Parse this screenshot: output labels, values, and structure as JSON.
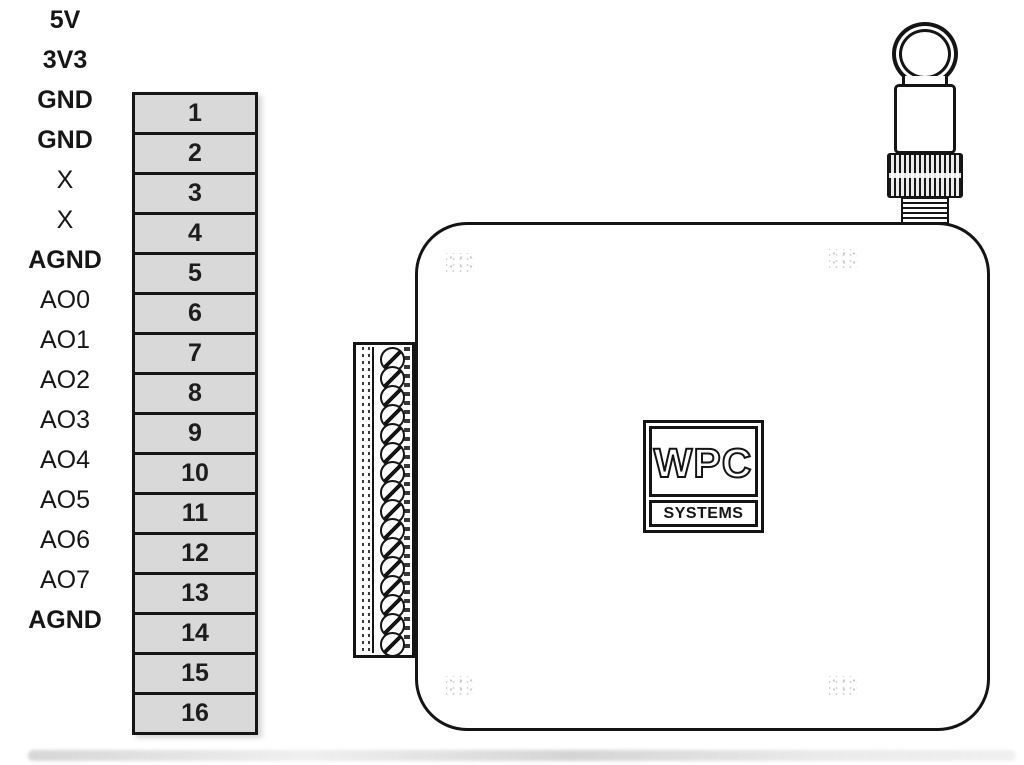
{
  "pin_table": {
    "cell_fill": "#d9d9d9",
    "border_color": "#161616",
    "rows": [
      {
        "label": "5V",
        "pin": "1",
        "bold_label": true
      },
      {
        "label": "3V3",
        "pin": "2",
        "bold_label": true
      },
      {
        "label": "GND",
        "pin": "3",
        "bold_label": true
      },
      {
        "label": "GND",
        "pin": "4",
        "bold_label": true
      },
      {
        "label": "X",
        "pin": "5",
        "bold_label": false
      },
      {
        "label": "X",
        "pin": "6",
        "bold_label": false
      },
      {
        "label": "AGND",
        "pin": "7",
        "bold_label": true
      },
      {
        "label": "AO0",
        "pin": "8",
        "bold_label": false
      },
      {
        "label": "AO1",
        "pin": "9",
        "bold_label": false
      },
      {
        "label": "AO2",
        "pin": "10",
        "bold_label": false
      },
      {
        "label": "AO3",
        "pin": "11",
        "bold_label": false
      },
      {
        "label": "AO4",
        "pin": "12",
        "bold_label": false
      },
      {
        "label": "AO5",
        "pin": "13",
        "bold_label": false
      },
      {
        "label": "AO6",
        "pin": "14",
        "bold_label": false
      },
      {
        "label": "AO7",
        "pin": "15",
        "bold_label": false
      },
      {
        "label": "AGND",
        "pin": "16",
        "bold_label": true
      }
    ]
  },
  "device": {
    "logo_primary": "WPC",
    "logo_secondary": "SYSTEMS",
    "terminal_screw_count": 16
  }
}
